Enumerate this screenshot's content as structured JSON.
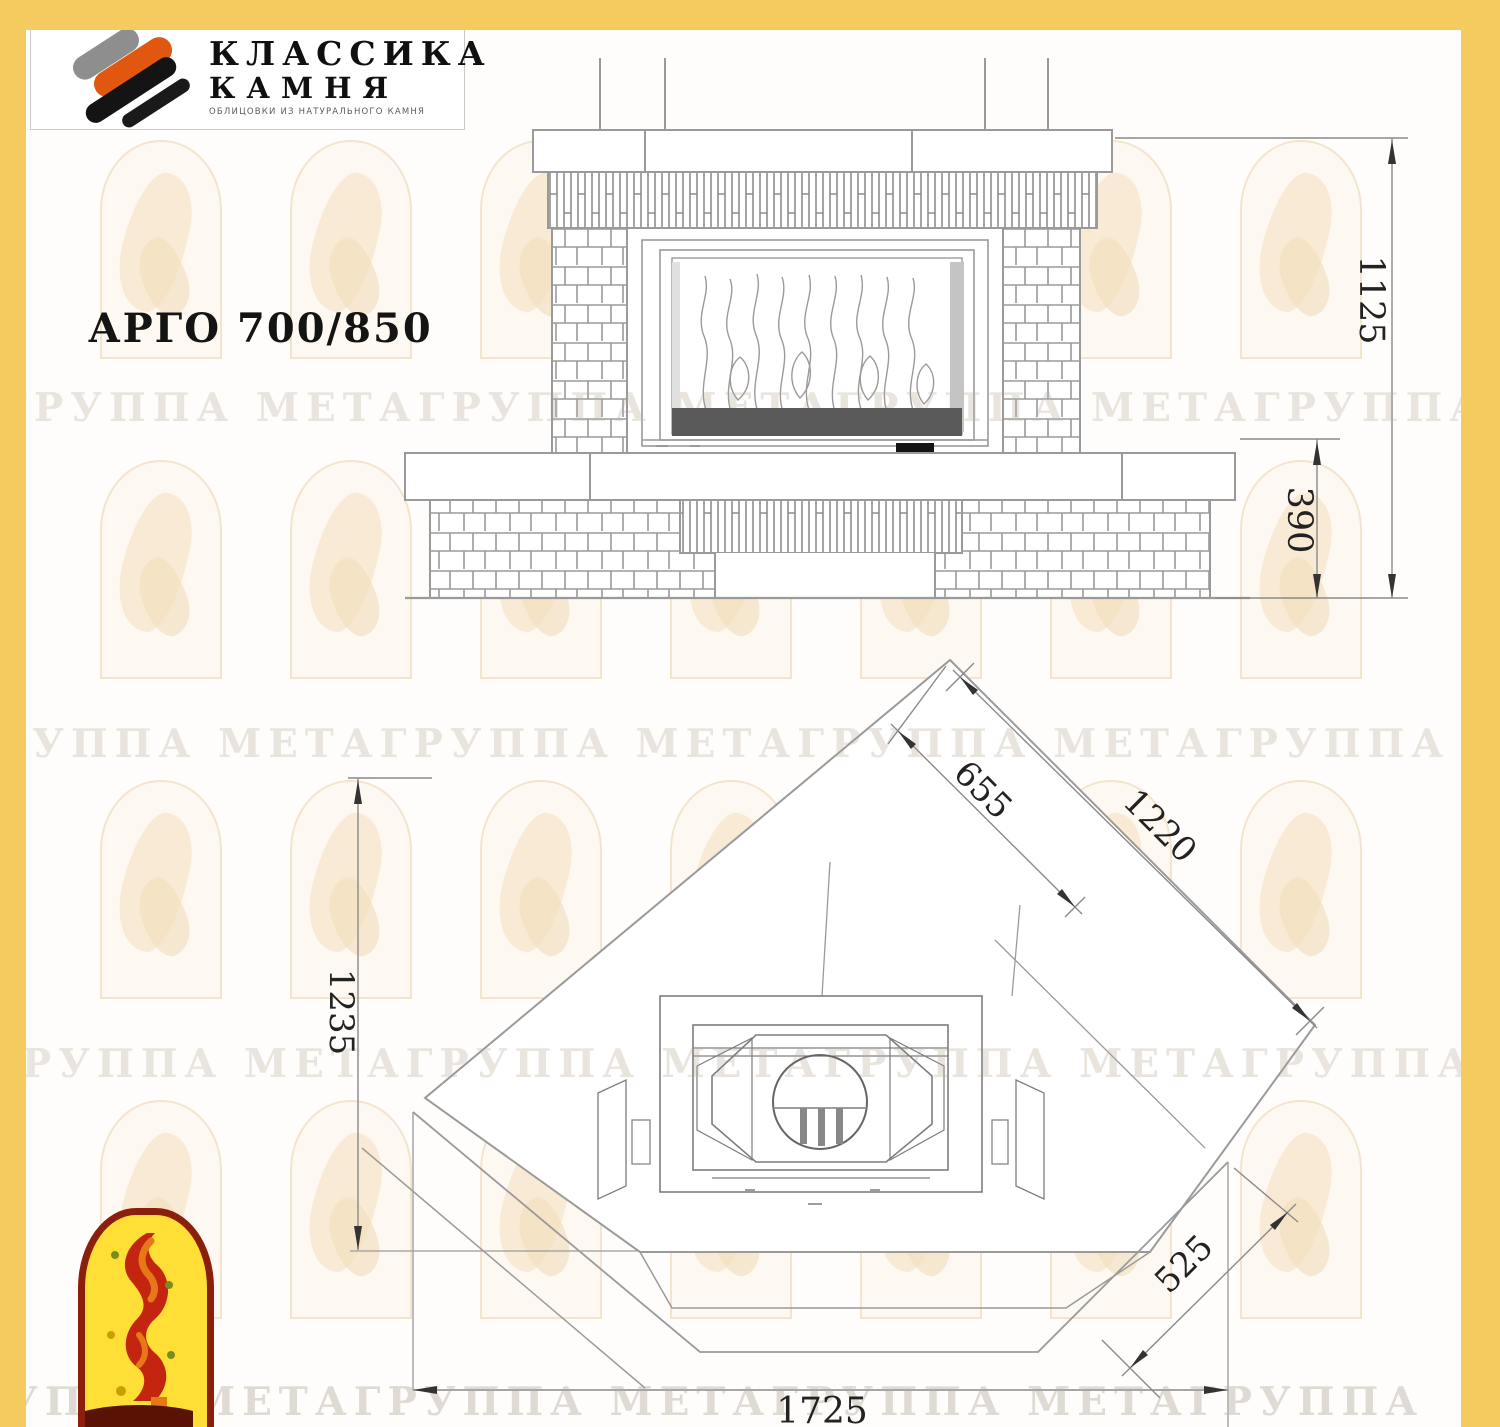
{
  "page": {
    "background": "#FEFDFB",
    "frame_color": "#F5CB5F"
  },
  "logo": {
    "line1": "КЛАССИКА",
    "line2": "КАМНЯ",
    "tagline": "ОБЛИЦОВКИ ИЗ НАТУРАЛЬНОГО КАМНЯ"
  },
  "title": "АРГО 700/850",
  "watermark": {
    "text": "ГРУППА МЕТАГРУППА МЕТАГРУППА МЕТАГРУППА МЕТАГРУППА МЕТА"
  },
  "drawing": {
    "front_view": {
      "dim_total_height": "1125",
      "dim_bench_height": "390"
    },
    "plan_view": {
      "dim_inner_side": "655",
      "dim_outer_side": "1220",
      "dim_depth": "1235",
      "dim_chamfer": "525",
      "dim_total_width": "1725"
    }
  },
  "colors": {
    "accent_orange": "#E2570F",
    "emblem_red": "#8C1E0C",
    "emblem_yellow": "#FFDE35",
    "line_gray": "#999999"
  }
}
